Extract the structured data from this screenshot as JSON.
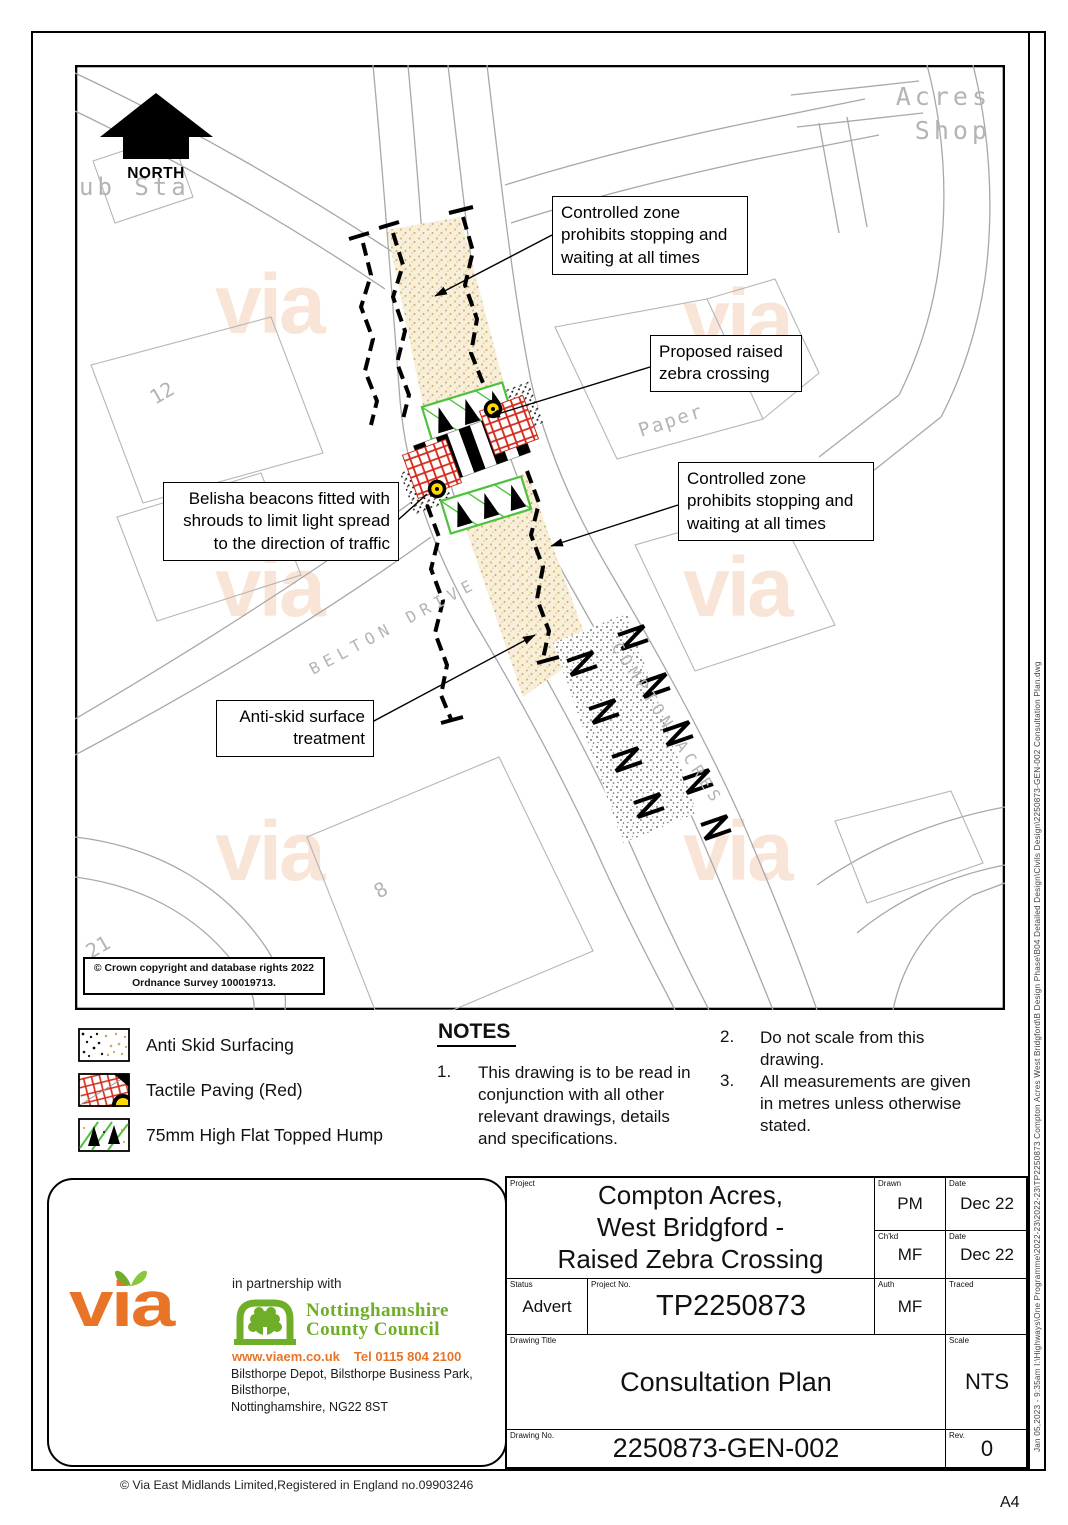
{
  "sheet": {
    "page_size_label": "A4",
    "footer_copyright": "© Via East Midlands Limited,Registered in England no.09903246",
    "file_path_note": "Jan 05,2023 - 9:35am   I:\\Highways\\One Programme\\2022-23\\2022-23\\TP2250873 Compton Acres West Bridgford\\B Design Phase\\B04 Detailed Design\\Civils Design\\2250873-GEN-002 Consultation Plan.dwg"
  },
  "map": {
    "north_label": "NORTH",
    "watermark_text": "via",
    "labels": {
      "sub_station": "ub Sta",
      "acres_line1": "Acres",
      "acres_line2": "Shop",
      "paper": "Paper",
      "belton_drive": "BELTON DRIVE",
      "compton_acres": "COMPTON ACRES",
      "house_no_12": "12",
      "house_no_8": "8",
      "house_no_21": "21"
    },
    "callouts": {
      "controlled_zone_top": "Controlled zone prohibits stopping and waiting at all times",
      "proposed_crossing": "Proposed raised zebra crossing",
      "belisha_beacons": "Belisha beacons fitted with shrouds to limit light spread to the direction of traffic",
      "controlled_zone_bottom": "Controlled zone prohibits stopping and waiting at all times",
      "anti_skid": "Anti-skid surface treatment"
    },
    "copyright_line1": "© Crown copyright and database rights 2022",
    "copyright_line2": "Ordnance Survey 100019713."
  },
  "legend": {
    "items": [
      {
        "label": "Anti Skid Surfacing"
      },
      {
        "label": "Tactile Paving (Red)"
      },
      {
        "label": "75mm High Flat Topped Hump"
      }
    ]
  },
  "notes": {
    "title": "NOTES",
    "items": [
      {
        "num": "1.",
        "text": "This drawing is to be read in conjunction with all other relevant drawings, details and specifications."
      },
      {
        "num": "2.",
        "text": "Do not scale from this drawing."
      },
      {
        "num": "3.",
        "text": "All measurements are given in metres unless otherwise stated."
      }
    ]
  },
  "title_block": {
    "project_label": "Project",
    "project_line1": "Compton Acres,",
    "project_line2": "West Bridgford -",
    "project_line3": "Raised Zebra Crossing",
    "drawn_label": "Drawn",
    "drawn_value": "PM",
    "drawn_date_label": "Date",
    "drawn_date_value": "Dec 22",
    "checked_label": "Ch'kd",
    "checked_value": "MF",
    "checked_date_label": "Date",
    "checked_date_value": "Dec 22",
    "status_label": "Status",
    "status_value": "Advert",
    "project_no_label": "Project No.",
    "project_no_value": "TP2250873",
    "auth_label": "Auth",
    "auth_value": "MF",
    "traced_label": "Traced",
    "traced_value": "",
    "drawing_title_label": "Drawing Title",
    "drawing_title_value": "Consultation Plan",
    "scale_label": "Scale",
    "scale_value": "NTS",
    "drawing_no_label": "Drawing No.",
    "drawing_no_value": "2250873-GEN-002",
    "rev_label": "Rev.",
    "rev_value": "0"
  },
  "branding": {
    "via_logo_text": "via",
    "partnership_text": "in partnership with",
    "council_name_line1": "Nottinghamshire",
    "council_name_line2": "County Council",
    "website": "www.viaem.co.uk",
    "telephone": "Tel 0115 804 2100",
    "address_line1": "Bilsthorpe Depot, Bilsthorpe Business Park, Bilsthorpe,",
    "address_line2": "Nottinghamshire, NG22 8ST"
  },
  "colors": {
    "via_orange": "#e87428",
    "council_green": "#6fae28",
    "tactile_red": "#d42718",
    "hump_green": "#4ec23c",
    "beacon_yellow": "#ffd900",
    "antiskid_tan": "#cfa85f"
  }
}
